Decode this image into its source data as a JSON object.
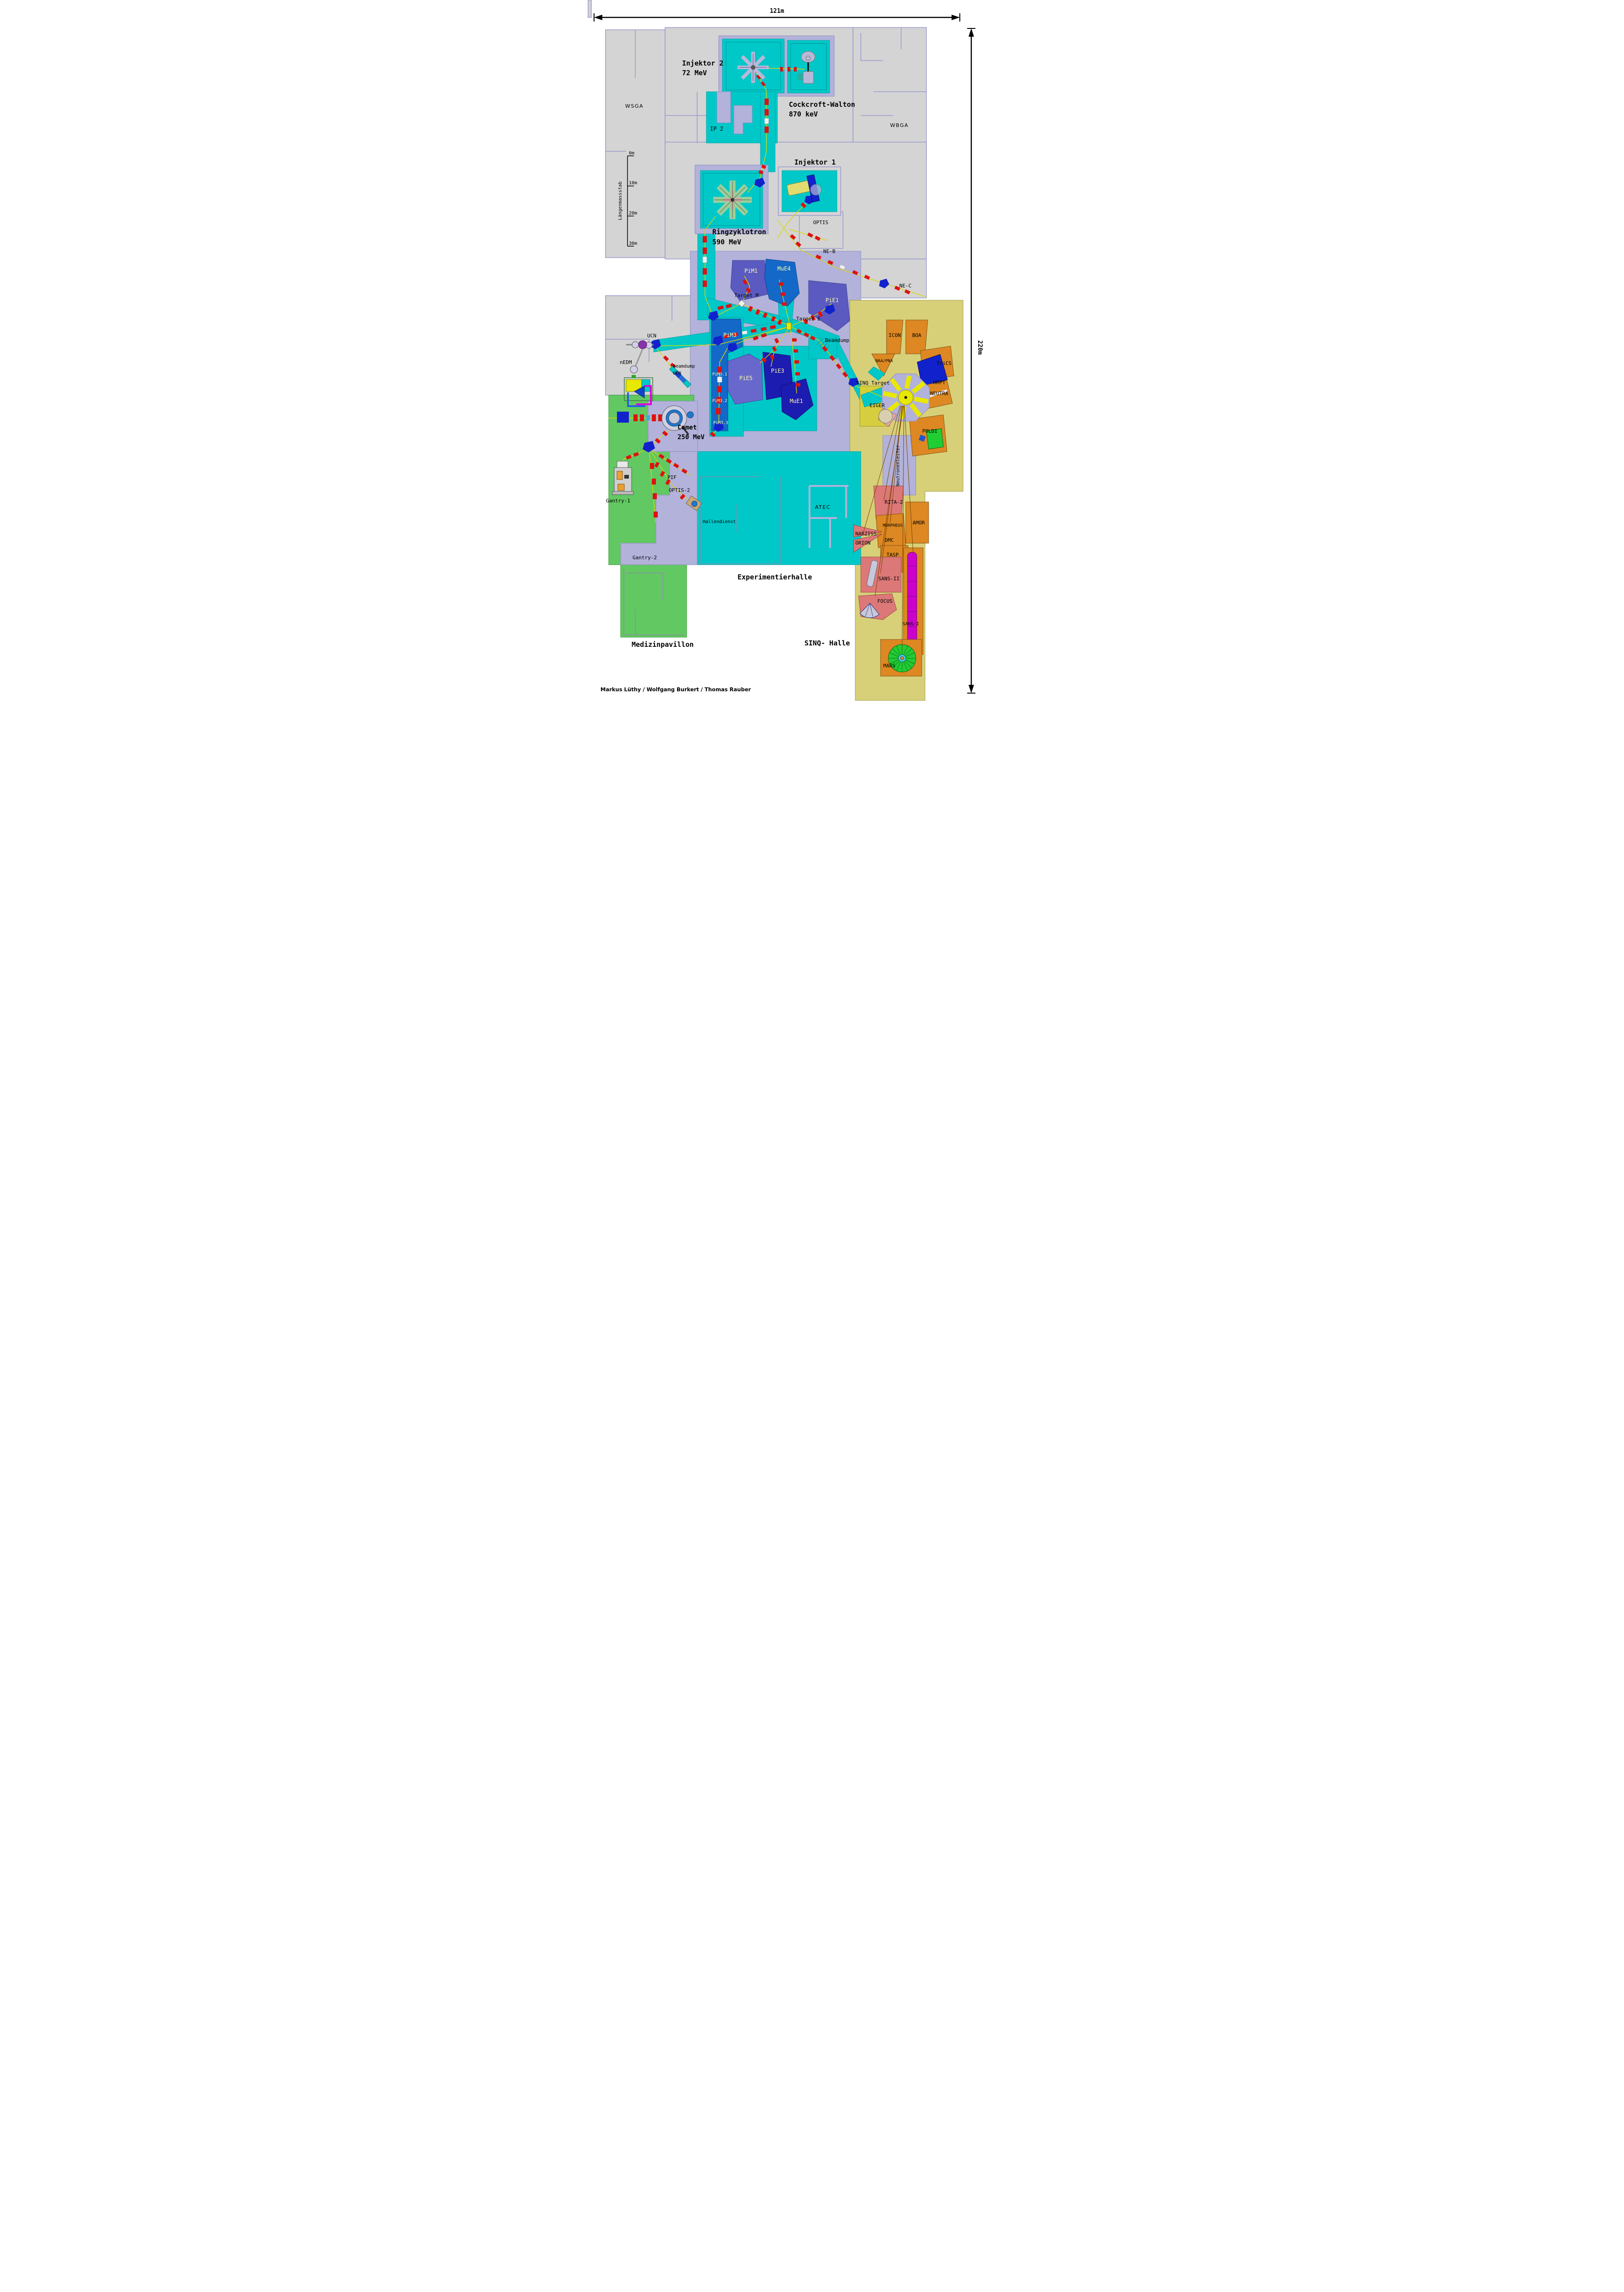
{
  "scale_bars": {
    "horizontal": "121m",
    "vertical": "220m",
    "ruler_title": "Längenmassstab",
    "ruler_ticks": [
      "0m",
      "10m",
      "20m",
      "30m"
    ]
  },
  "facilities": {
    "injektor2_name": "Injektor 2",
    "injektor2_energy": "72 MeV",
    "cockcroft_name": "Cockcroft-Walton",
    "cockcroft_energy": "870 keV",
    "injektor1_name": "Injektor 1",
    "ringzyklotron_name": "Ringzyklotron",
    "ringzyklotron_energy": "590 MeV",
    "comet_name": "Comet",
    "comet_energy": "250 MeV"
  },
  "buildings": {
    "wsga": "WSGA",
    "wbga": "WBGA",
    "experimentierhalle": "Experimentierhalle",
    "sinq_halle": "SINQ- Halle",
    "medizinpavillon": "Medizinpavillon",
    "hallendienst": "Hallendienst",
    "atec": "ATEC"
  },
  "beam_areas": {
    "ip2": "IP 2",
    "optis": "OPTIS",
    "ne_b": "NE-B",
    "ne_c": "NE-C",
    "pim1": "PiM1",
    "mue4": "MuE4",
    "pie1": "PiE1",
    "target_m": "Target M",
    "target_e": "Target E",
    "beamdump": "Beamdump",
    "ucn": "UCN",
    "nedm": "nEDM",
    "beamdump_ucn_1": "Beamdump",
    "beamdump_ucn_2": "UCN",
    "pim3": "PiM3",
    "pim31": "PiM3.1",
    "pim32": "PiM3.2",
    "pim33": "PiM3.3",
    "pie5": "PiE5",
    "pie3": "PiE3",
    "mue1": "MuE1",
    "pif": "PIF",
    "optis2": "OPTIS-2",
    "gantry1": "Gantry-1",
    "gantry2": "Gantry-2"
  },
  "sinq": {
    "target": "SINQ Target",
    "neutronenleiter": "Neutronenleiter",
    "icon": "ICON",
    "boa": "BOA",
    "naa_pna": "NAA/PNA",
    "trics": "TriCS",
    "hrpt": "HRPT",
    "neutra": "NEUTRA",
    "poldi": "POLDI",
    "eiger": "EIGER",
    "rita2": "RITA-2",
    "morpheus": "MORPHEUS",
    "amor": "AMOR",
    "narziss": "NARZISS",
    "orion": "ORION",
    "dmc": "DMC",
    "tasp": "TASP",
    "sans2": "SANS-II",
    "focus": "FOCUS",
    "sans1": "SANS-I",
    "mars": "MARS"
  },
  "credits": "Markus Lüthy / Wolfgang Burkert / Thomas Rauber",
  "colors": {
    "hall_cyan": "#00c8c8",
    "shield_lavender": "#b2b2da",
    "building_gray": "#d4d4d4",
    "medical_green": "#62c862",
    "sinq_khaki": "#d8d078",
    "instrument_orange": "#dd8822",
    "instrument_pink": "#dd7878",
    "eiger_yellow": "#d6ce3e",
    "beam_yellow": "#d8d800",
    "magnet_red": "#dd1111",
    "magnet_blue": "#1122cc",
    "area_purple": "#5a5ac0",
    "area_blue": "#1468c8",
    "area_navy": "#1c1cb0",
    "area_slate": "#6868cc",
    "label_yellow": "#ffffaa",
    "neutron_guide_brown": "#7a4400",
    "sans1_magenta": "#cc00cc",
    "mars_green": "#22cc33"
  }
}
